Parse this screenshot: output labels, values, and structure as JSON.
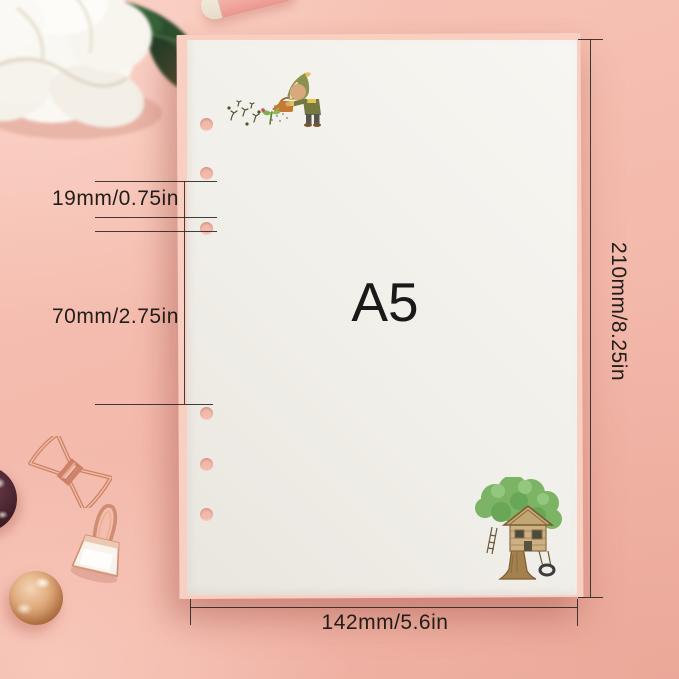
{
  "product": {
    "size_label": "A5"
  },
  "measurements": {
    "hole_spacing": "19mm/0.75in",
    "hole_group_gap": "70mm/2.75in",
    "page_height": "210mm/8.25in",
    "page_width": "142mm/5.6in"
  },
  "paper": {
    "hole_count": 6
  },
  "palette": {
    "background_pink": "#f4bbad",
    "paper_white": "#f1efe9",
    "pink_sheet_edge": "#f8cfc1",
    "rose_gold": "#d18f74",
    "dimension_line": "#2a2420"
  },
  "decorations": {
    "top_left": "white-peony-flower",
    "top_center": "pink-pen-cylinder",
    "mid_left": "rose-gold-bow-clip",
    "lower_left": "rose-gold-binder-clip",
    "bottom_left": "rose-gold-ball",
    "far_left": "dark-sphere",
    "paper_top_left": "child-watering-illustration",
    "paper_bottom_right": "treehouse-illustration"
  }
}
